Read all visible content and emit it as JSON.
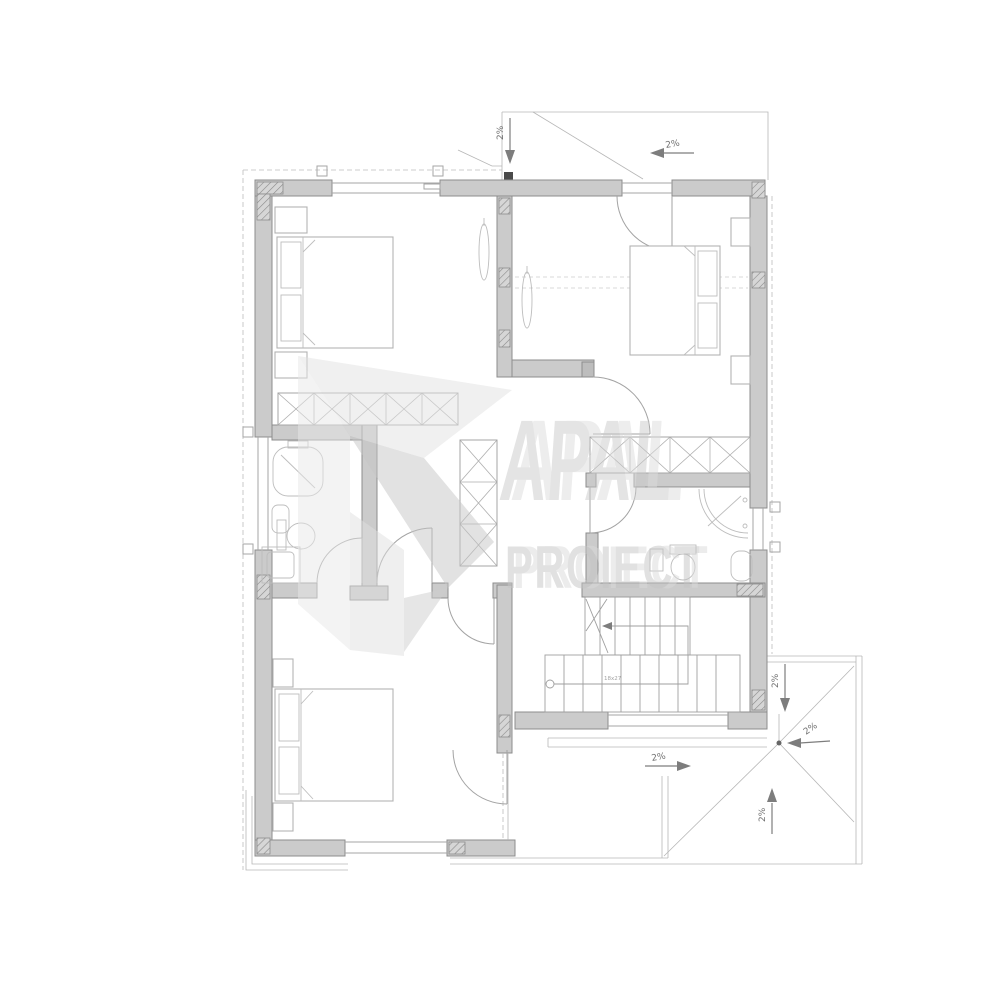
{
  "watermark": {
    "brand": "APAL",
    "subtitle": "PROIECT"
  },
  "slopes": [
    {
      "id": "top-center",
      "label": "2%"
    },
    {
      "id": "top-right",
      "label": "2%"
    },
    {
      "id": "terrace-right-upper",
      "label": "2%"
    },
    {
      "id": "terrace-drain",
      "label": "2%"
    },
    {
      "id": "terrace-bottom-up",
      "label": "2%"
    },
    {
      "id": "terrace-center-right",
      "label": "2%"
    }
  ],
  "stairs": {
    "label": "18x27"
  },
  "colors": {
    "wall_fill": "#cbcbcb",
    "wall_stroke": "#8d8d8d",
    "line": "#a6a6a6",
    "annotation": "#6f6f6f",
    "watermark": "#c9c9c9"
  }
}
